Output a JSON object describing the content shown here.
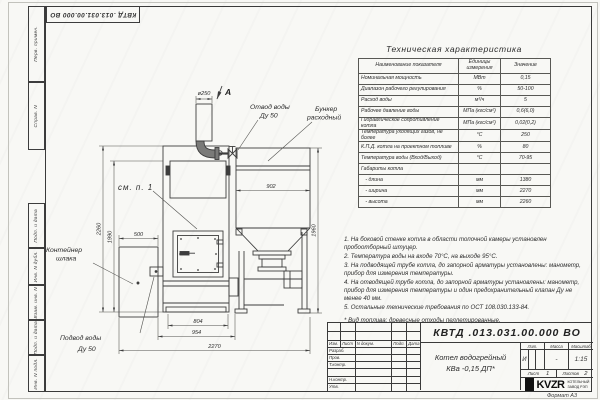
{
  "sheet": {
    "designation_top": "КВТД .013.031.00.000 ВО",
    "format_note": "Формат А3"
  },
  "frame_columns": {
    "perv_primen": "Перв. примен.",
    "sprav_n": "Справ. N",
    "podp_data_1": "Подп. и дата",
    "inv_dubl": "Инв. N дубл.",
    "vzam_inv": "Взам. инв. N",
    "podp_data_2": "Подп. и дата",
    "inv_podl": "Инв. N подл."
  },
  "tech_table": {
    "title": "Техническая характеристика",
    "headers": [
      "Наименование показателя",
      "Единицы измерения",
      "Значение"
    ],
    "rows": [
      {
        "name": "Номинальная мощность",
        "units": "МВт",
        "value": "0,15"
      },
      {
        "name": "Диапазон рабочего регулирования",
        "units": "%",
        "value": "50-100"
      },
      {
        "name": "Расход воды",
        "units": "м³/ч",
        "value": "5"
      },
      {
        "name": "Рабочее давление воды",
        "units": "МПа (кгс/см²)",
        "value": "0,6(6,0)"
      },
      {
        "name": "Гидравлическое сопротивление котла",
        "units": "МПа (кгс/см²)",
        "value": "0,02(0,2)"
      },
      {
        "name": "Температура уходящих газов, не более",
        "units": "°С",
        "value": "250"
      },
      {
        "name": "К.П.Д. котла на проектном топливе",
        "units": "%",
        "value": "80"
      },
      {
        "name": "Температура воды (Вход/Выход)",
        "units": "°С",
        "value": "70-95"
      },
      {
        "name": "Габариты котла",
        "units": "",
        "value": ""
      },
      {
        "name": "   - длина",
        "units": "мм",
        "value": "1380"
      },
      {
        "name": "   - ширина",
        "units": "мм",
        "value": "2270"
      },
      {
        "name": "   - высота",
        "units": "мм",
        "value": "2260"
      }
    ]
  },
  "notes": [
    "1. На боковой стенке котла в области топочной камеры установлен пробоотборный штуцер.",
    "2. Температура воды на входе 70°С, на выходе 95°С.",
    "3. На подводящей трубе котла, до запорной арматуры установлены: манометр, прибор для измерения температуры.",
    "4. На отводящей трубе котла, до запорной арматуры установлены: манометр, прибор для измерения температуры и один предохранительный клапан Ду не менее 40 мм.",
    "5. Остальные технические требования по ОСТ 108.030.133-84."
  ],
  "fuel_note": "* Вид топлива: древесные отходы пеллетированные.",
  "drawing": {
    "view_label": "А",
    "see_note": "см. п. 1",
    "labels": {
      "water_out_1": "Отвод воды",
      "water_out_2": "Ду 50",
      "bunker_1": "Бункер",
      "bunker_2": "расходный",
      "slag_1": "Контейнер",
      "slag_2": "шлака",
      "water_in_1": "Подвод воды",
      "water_in_2": "Ду 50"
    },
    "dimensions": {
      "chimney_d": "ø250",
      "slag_w": "500",
      "bunker_w": "902",
      "boiler_h": "2260",
      "boiler_h2": "1990",
      "bunker_h": "1960",
      "base_w1": "804",
      "base_w2": "954",
      "total_w": "2270"
    }
  },
  "title_block": {
    "designation": "КВТД .013.031.00.000  ВО",
    "product_line1": "Котел водогрейный",
    "product_line2": "КВа -0,15  ДП*",
    "change_header": [
      "Изм.",
      "Лист",
      "N докум.",
      "Подп.",
      "Дата"
    ],
    "roles": [
      "Разраб.",
      "Пров.",
      "Т.контр.",
      "",
      "Н.контр.",
      "Утв."
    ],
    "lit_header": "Лит.",
    "mass_header": "Масса",
    "scale_header": "Масштаб",
    "lit_value": "И",
    "mass_value": "-",
    "scale_value": "1:15",
    "sheet_label": "Лист",
    "sheet_value": "1",
    "sheets_label": "Листов",
    "sheets_value": "2",
    "company": "KVZR",
    "company_sub1": "КОТЕЛЬНЫЙ",
    "company_sub2": "ЗАВОД РЭП"
  }
}
